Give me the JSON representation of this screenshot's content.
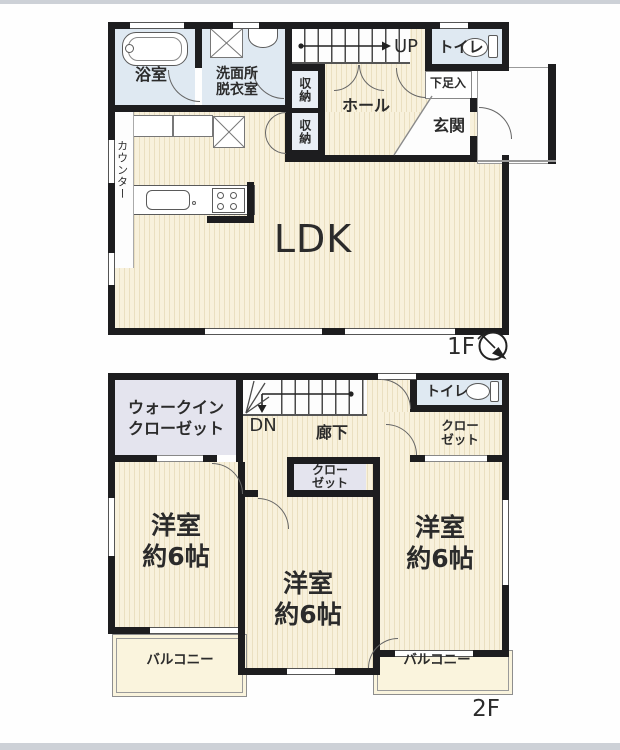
{
  "floor1": {
    "floor_label": "1F",
    "rooms": {
      "bath": "浴室",
      "washroom": "洗面所\n脱衣室",
      "storage1": "収納",
      "storage2": "収納",
      "stairs_up": "UP",
      "toilet": "トイレ",
      "shoe_box": "下足入",
      "entrance": "玄関",
      "hall": "ホール",
      "counter": "カウンター",
      "ldk": "LDK"
    }
  },
  "floor2": {
    "floor_label": "2F",
    "rooms": {
      "walk_in_closet": "ウォークイン\nクローゼット",
      "stairs_down": "DN",
      "corridor": "廊下",
      "toilet": "トイレ",
      "closet_right": "クロー\nゼット",
      "closet_middle": "クロー\nゼット",
      "room_left": "洋室\n約6帖",
      "room_middle": "洋室\n約6帖",
      "room_right": "洋室\n約6帖",
      "balcony_left": "バルコニー",
      "balcony_right": "バルコニー"
    }
  },
  "icons": [
    "compass-icon",
    "bathtub-icon",
    "washing-machine-icon",
    "sink-icon",
    "kitchen-sink-icon",
    "stove-icon",
    "toilet-icon"
  ],
  "colors": {
    "wall": "#1d1d1f",
    "wood_floor": "#f8f1dc",
    "wood_stripe": "#eadfc0",
    "wet_room": "#dfe9f2",
    "closet": "#e4e4ee",
    "balcony": "#faf4dd",
    "page_edge": "#cdd1d7"
  }
}
